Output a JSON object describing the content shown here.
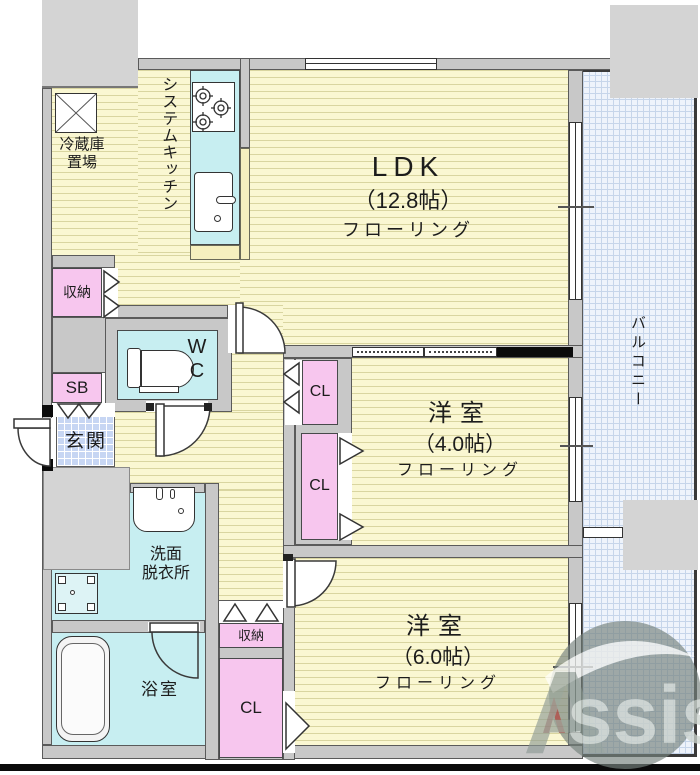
{
  "rooms": {
    "ldk": {
      "name": "LDK",
      "size": "（12.8帖）",
      "floor": "フローリング"
    },
    "room4": {
      "name": "洋室",
      "size": "（4.0帖）",
      "floor": "フローリング"
    },
    "room6": {
      "name": "洋室",
      "size": "（6.0帖）",
      "floor": "フローリング"
    },
    "balcony": {
      "name": "バルコニー"
    },
    "genkan": {
      "name": "玄関"
    },
    "kitchen": {
      "name": "システムキッチン"
    },
    "fridge": {
      "line1": "冷蔵庫",
      "line2": "置場"
    },
    "wc": {
      "line1": "W",
      "line2": "C"
    },
    "washroom": {
      "line1": "洗面",
      "line2": "脱衣所"
    },
    "bathroom": {
      "name": "浴室"
    }
  },
  "closets": {
    "shuno_top": "収納",
    "sb": "SB",
    "cl_top": "CL",
    "cl_mid": "CL",
    "shuno_bottom": "収納",
    "cl_bottom": "CL"
  },
  "watermark": {
    "text_a": "A",
    "text_rest": "ssist"
  },
  "colors": {
    "floor_yellow": "#faf7d2",
    "floor_stripe": "#d9d5a0",
    "wet_area_cyan": "#c7eef1",
    "closet_pink": "#f7c6ee",
    "wall_gray": "#c8c8c8",
    "balcony_blue": "#eef3fb",
    "genkan_blue": "#c7d6f3",
    "solid_wall_black": "#0b0b0b",
    "watermark_red": "#a33b3b",
    "watermark_gray": "#8d9a94"
  }
}
